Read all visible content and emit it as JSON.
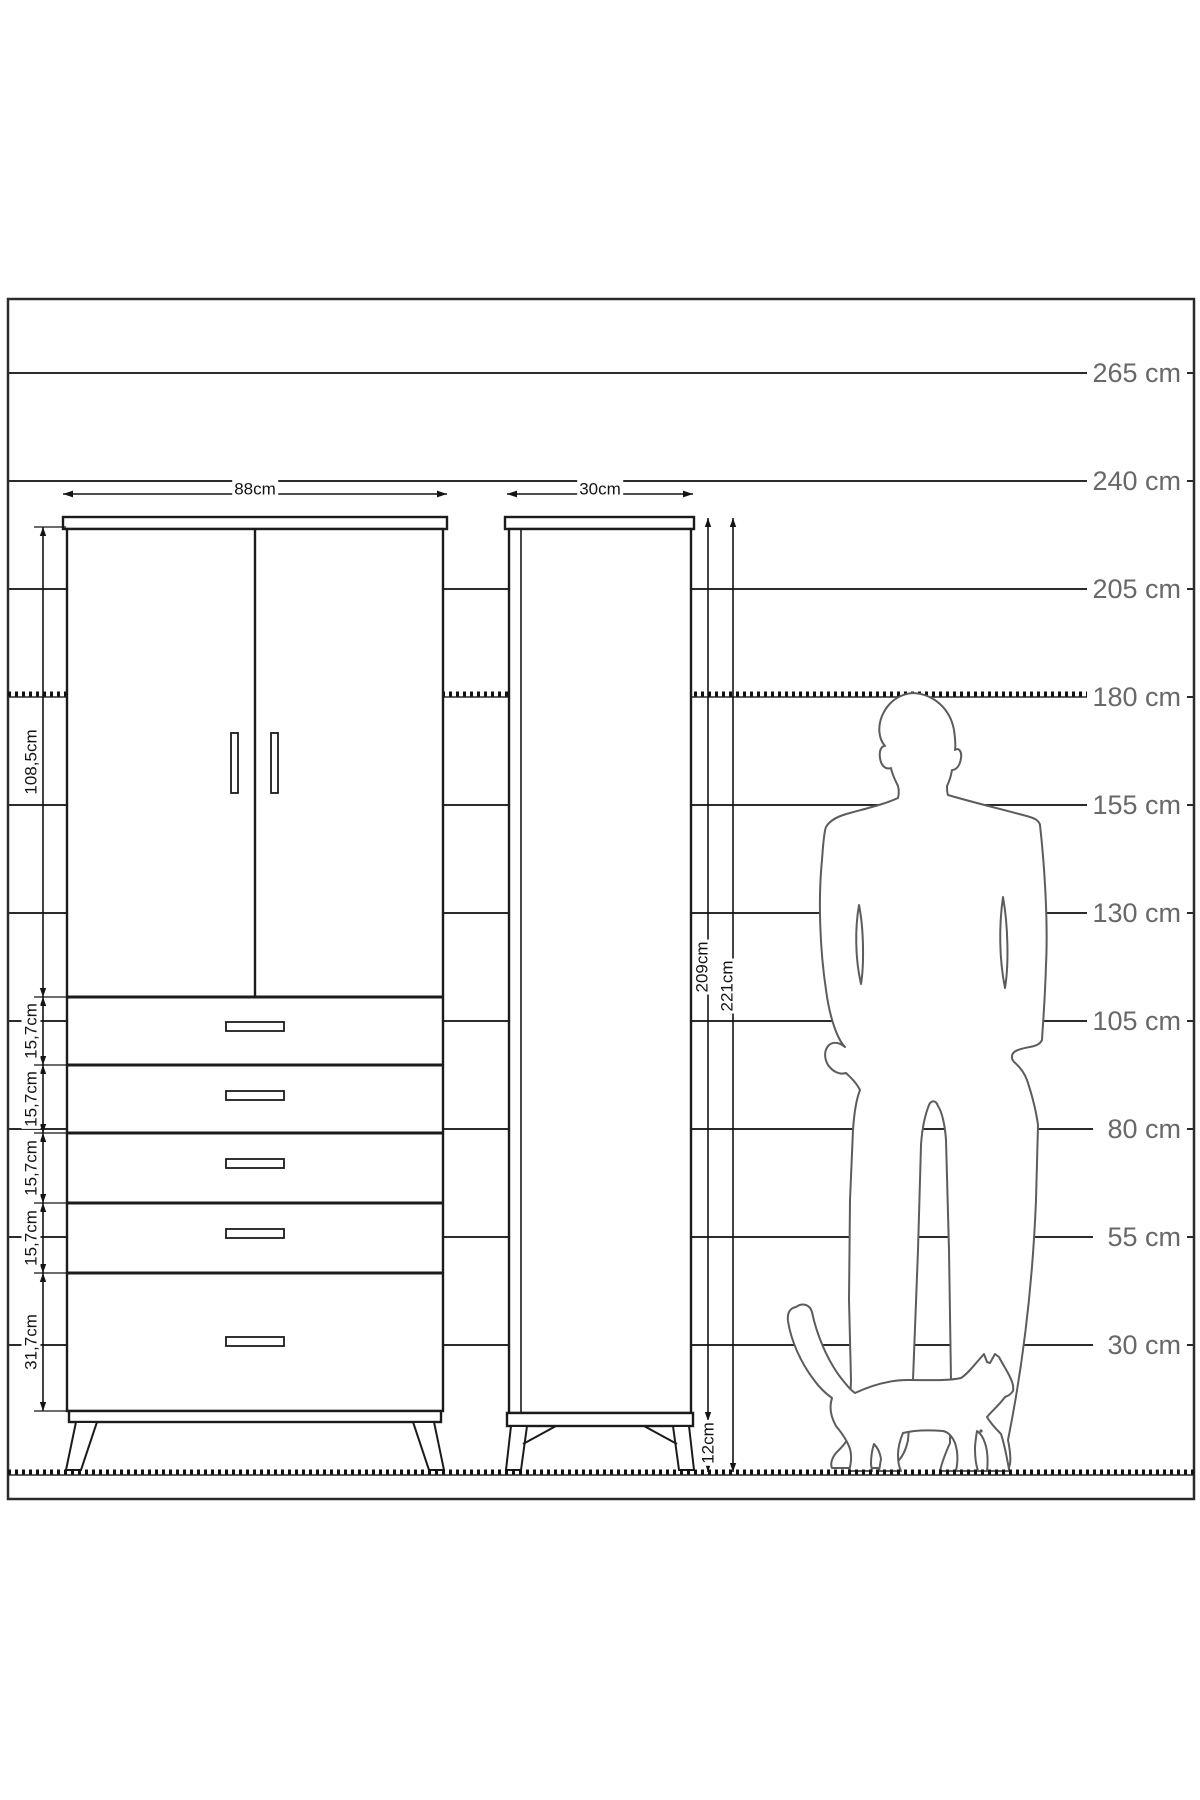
{
  "diagram_title": "wardrobe-dimension-drawing",
  "colors": {
    "background": "#ffffff",
    "line": "#1b1b1b",
    "scale_line": "#2b2b2b",
    "scale_text": "#686868",
    "silhouette": "#5c5c5c"
  },
  "height_scale": {
    "unit": "cm",
    "labels": [
      "265 cm",
      "240 cm",
      "205 cm",
      "180 cm",
      "155 cm",
      "130 cm",
      "105 cm",
      "80 cm",
      "55 cm",
      "30 cm"
    ],
    "values": [
      265,
      240,
      205,
      180,
      155,
      130,
      105,
      80,
      55,
      30
    ],
    "dashed_values": [
      180,
      0
    ]
  },
  "front_view": {
    "name": "wardrobe front view",
    "width": "88cm",
    "door_section_height": "108,5cm",
    "drawer_heights": [
      "15,7cm",
      "15,7cm",
      "15,7cm",
      "15,7cm",
      "31,7cm"
    ],
    "door_count": 2,
    "drawer_count": 5
  },
  "side_view": {
    "name": "wardrobe side view",
    "depth": "30cm",
    "body_height": "209cm",
    "total_height": "221cm",
    "leg_height": "12cm"
  }
}
